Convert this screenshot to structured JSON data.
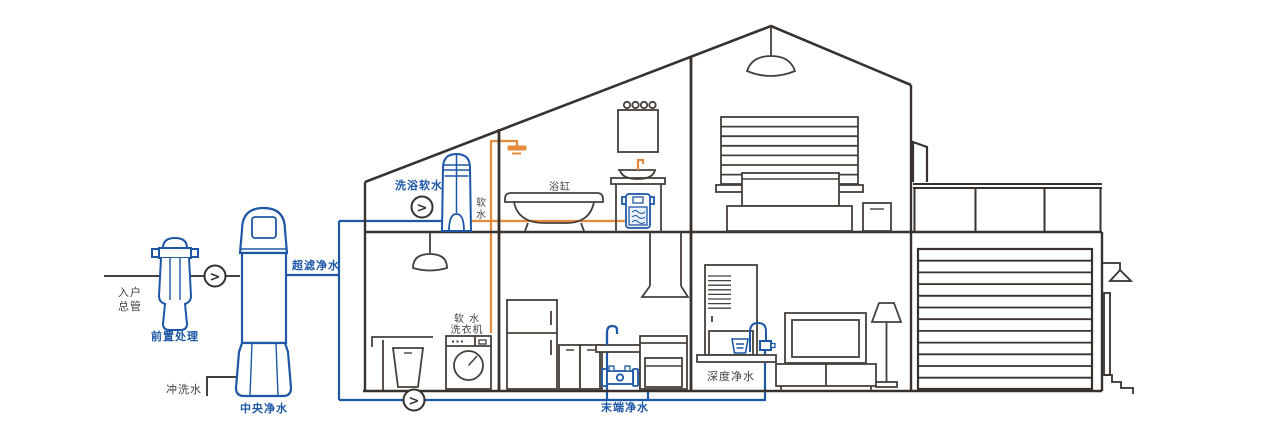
{
  "colors": {
    "pipe_blue": "#1e57a5",
    "pipe_orange": "#e78a3c",
    "line_ink": "#45403b"
  },
  "icons": {
    "flow_direction_glyph": ">"
  },
  "labels": {
    "inlet_main_line1": "入户",
    "inlet_main_line2": "总管",
    "pre_treatment": "前置处理",
    "central_purifier": "中央净水",
    "ultrafiltration_water": "超滤净水",
    "flush_water": "冲洗水",
    "bath_softener": "洗浴软水",
    "soft_water": "软水",
    "bathtub": "浴缸",
    "soft_washer_line1": "软 水",
    "soft_washer_line2": "洗衣机",
    "terminal_purifier": "末端净水",
    "deep_purifier": "深度净水"
  }
}
